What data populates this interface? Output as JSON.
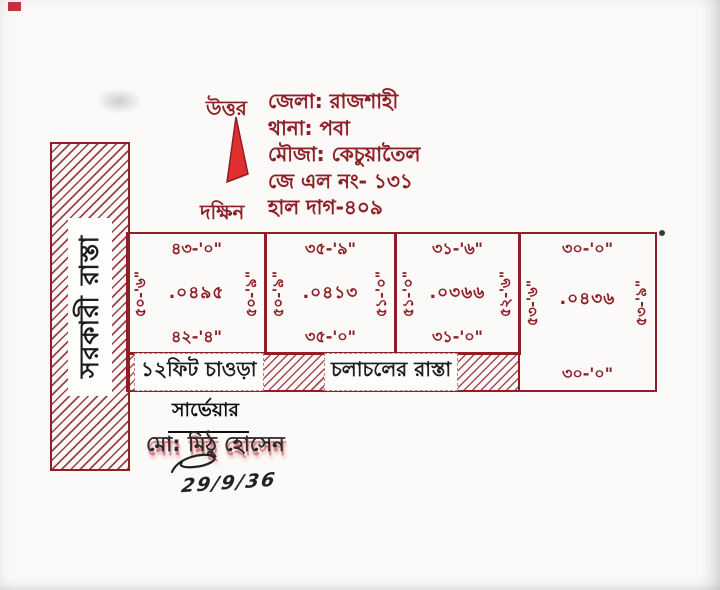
{
  "compass": {
    "north": "উত্তর",
    "south": "দক্ষিন"
  },
  "header": {
    "lines": [
      "জেলা: রাজশাহী",
      "থানা: পবা",
      "মৌজা: কেচুয়াতৈল",
      "জে এল নং- ১৩১",
      "হাল দাগ-৪০৯"
    ]
  },
  "left_road": {
    "label": "সরকারী রাস্তা"
  },
  "plots": [
    {
      "top_width": "৪৩-'০\"",
      "area": ".০৪৯৫",
      "bottom_width": "৪২-'৪\"",
      "west_depth": "৫০-'৬\"",
      "east_depth": "৫০-'৯\""
    },
    {
      "top_width": "৩৫-'৯\"",
      "area": ".০৪১৩",
      "bottom_width": "৩৫-'০\"",
      "west_depth": "৫০-'৯\"",
      "east_depth": "৫১-'০\""
    },
    {
      "top_width": "৩১-'৬\"",
      "area": ".০৩৬৬",
      "bottom_width": "৩১-'০\"",
      "west_depth": "৫১-'০\"",
      "east_depth": "৫২-'৬\""
    },
    {
      "top_width": "৩০-'০\"",
      "area": ".০৪৩৬",
      "bottom_width": "৩০-'০\"",
      "west_depth": "৫৩-'৬\"",
      "east_depth": "৫৩-'৯\""
    }
  ],
  "access_road": {
    "width_label": "১২ফিট চাওড়া",
    "name_label": "চলাচলের রাস্তা"
  },
  "surveyor": {
    "title": "সার্ভেয়ার",
    "name": "মো: মিঠু হোসেন",
    "signature_date": "29/9/36"
  },
  "colors": {
    "line": "#8e1f26",
    "arrow": "#e02f2f",
    "ink": "#1d1d1b",
    "paper": "#fbfaf8"
  }
}
